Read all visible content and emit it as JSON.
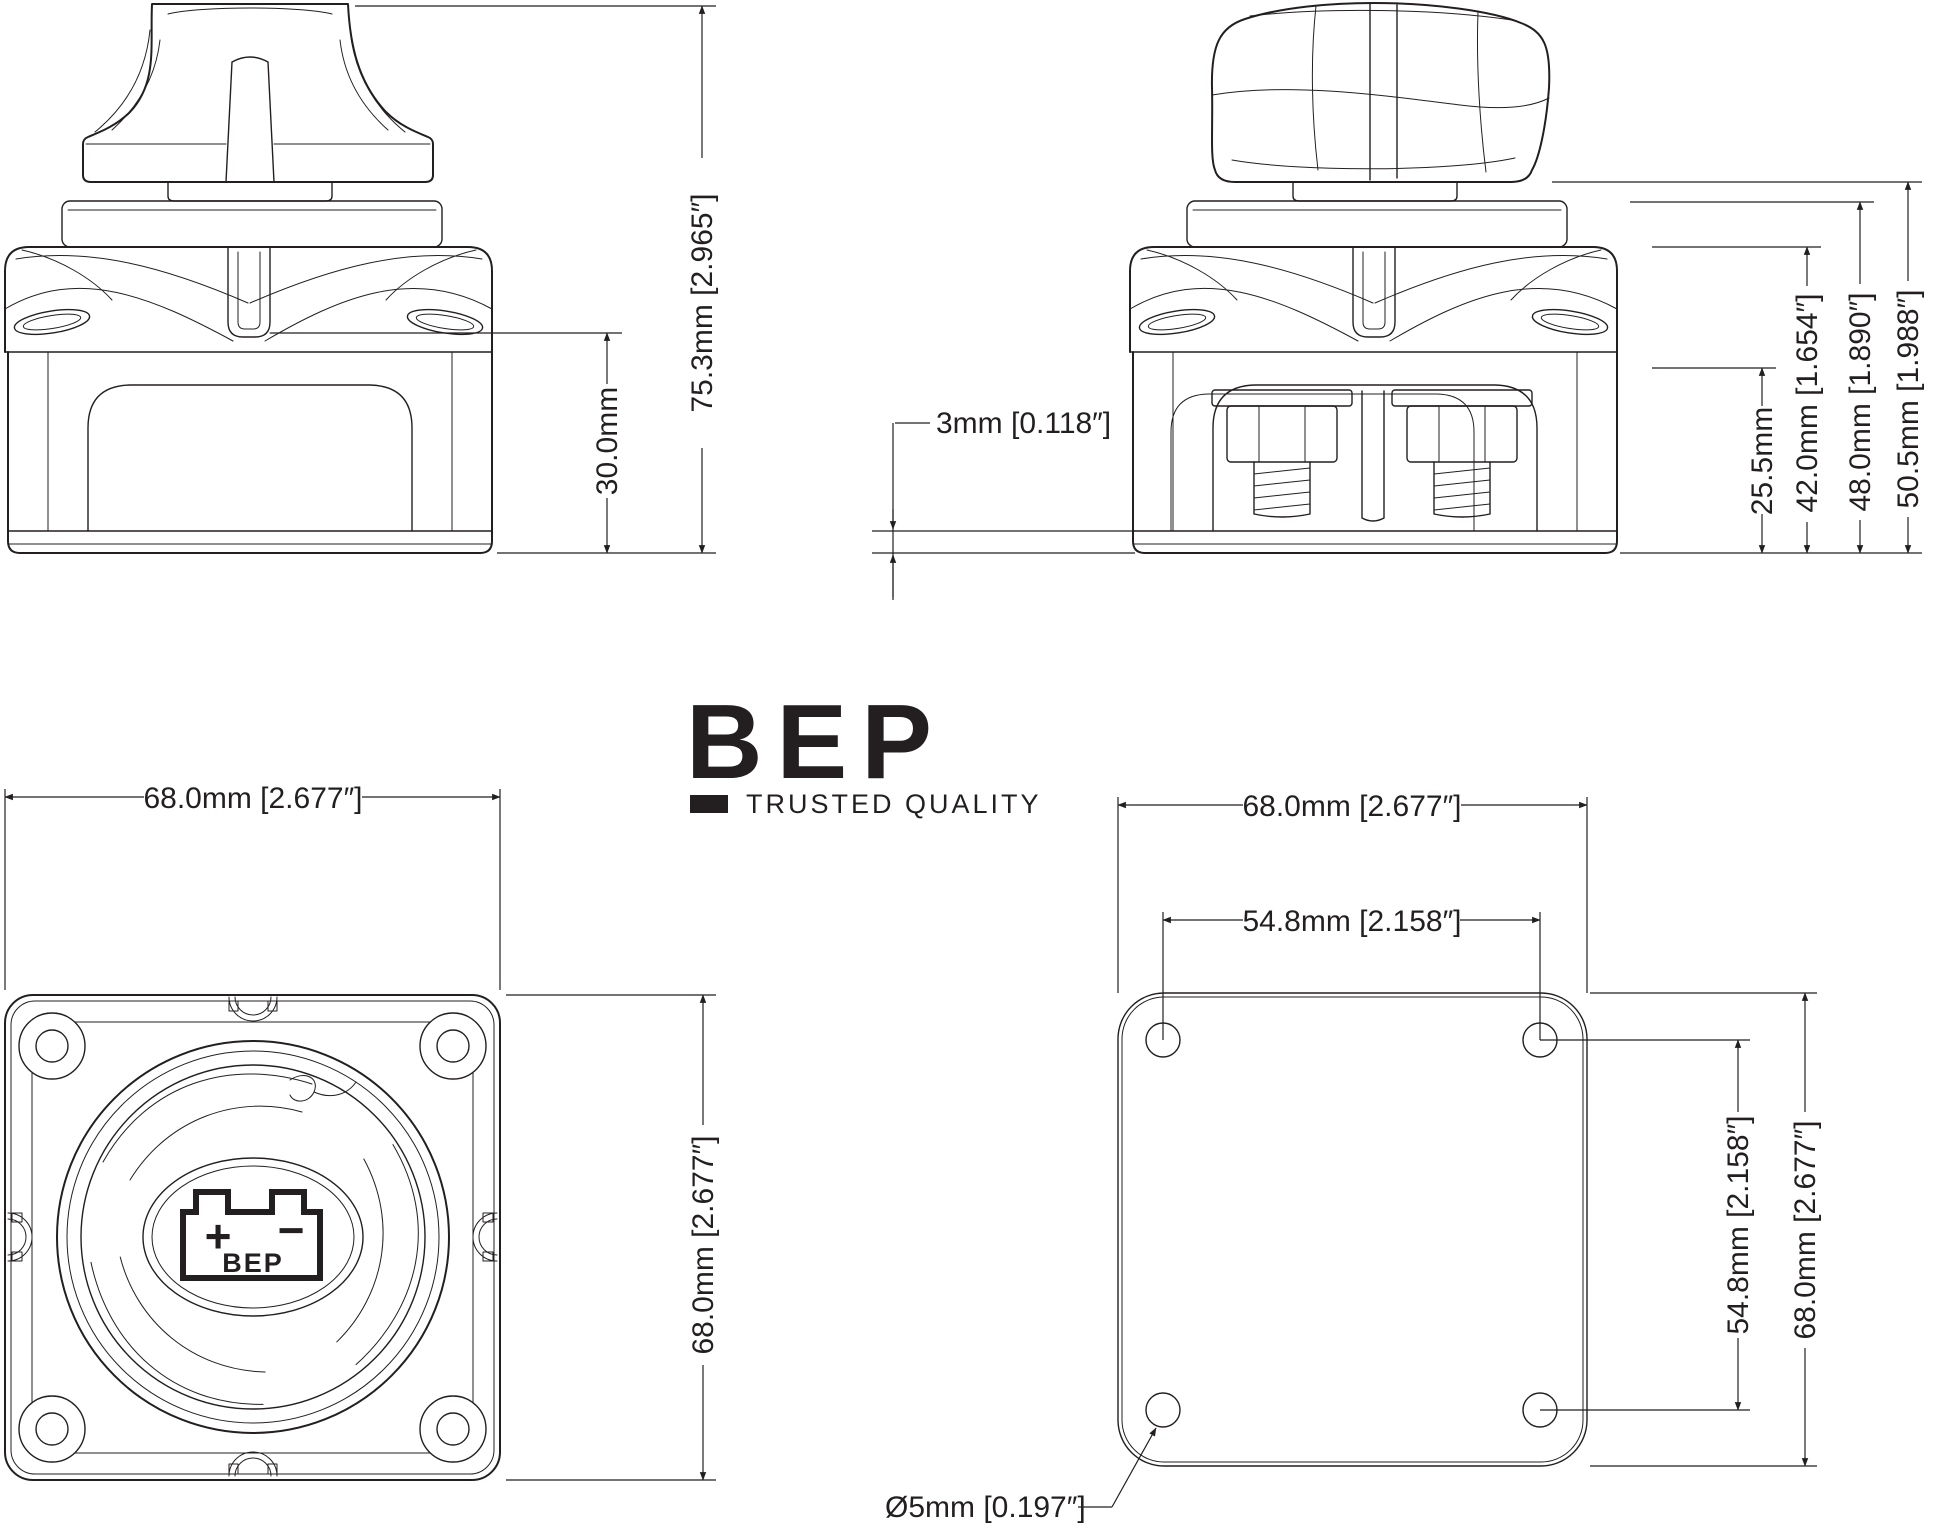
{
  "page": {
    "background": "#ffffff",
    "line_color": "#231f20"
  },
  "brand": {
    "logo": "BEP",
    "tagline": "TRUSTED QUALITY"
  },
  "views": {
    "front": {
      "overall_height": "75.3mm [2.965″]",
      "base_height": "30.0mm"
    },
    "side": {
      "recess_depth": "3mm [0.118″]",
      "stud_height": "25.5mm",
      "flange_height": "42.0mm [1.654″]",
      "collar_height": "48.0mm [1.890″]",
      "body_height": "50.5mm [1.988″]"
    },
    "face": {
      "width": "68.0mm [2.677″]",
      "height": "68.0mm [2.677″]",
      "battery_plus": "+",
      "battery_minus": "−",
      "battery_label": "BEP"
    },
    "template": {
      "width": "68.0mm [2.677″]",
      "hole_spacing_x": "54.8mm [2.158″]",
      "hole_spacing_y": "54.8mm [2.158″]",
      "height": "68.0mm [2.677″]",
      "hole_diameter": "Ø5mm [0.197″]"
    }
  }
}
